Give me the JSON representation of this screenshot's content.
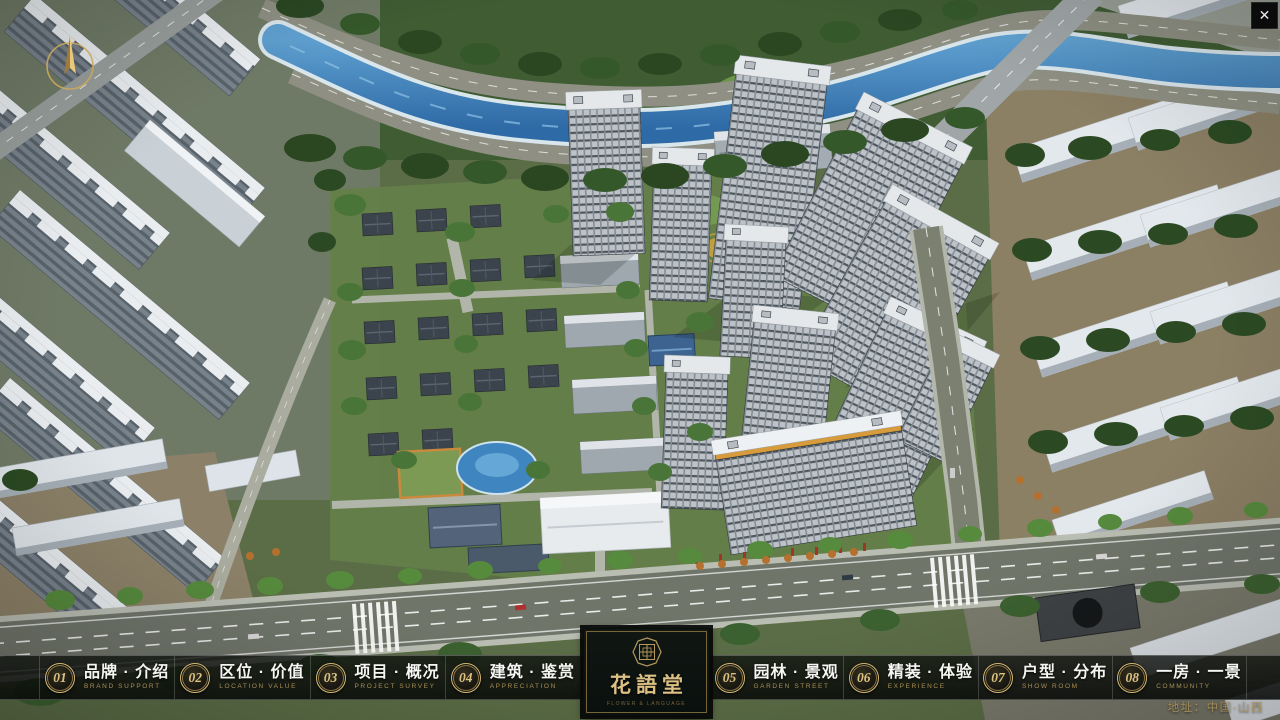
{
  "icons": {
    "close": "✕",
    "compass": "north-arrow",
    "seal": "hua-yu-tang-seal"
  },
  "project": {
    "name": "花語堂",
    "subtitle": "FLOWER & LANGUAGE",
    "address": "地址：中国·山西"
  },
  "menu": {
    "items": [
      {
        "num": "01",
        "label": "品牌 · 介绍",
        "en": "BRAND SUPPORT"
      },
      {
        "num": "02",
        "label": "区位 · 价值",
        "en": "LOCATION VALUE"
      },
      {
        "num": "03",
        "label": "项目 · 概况",
        "en": "PROJECT SURVEY"
      },
      {
        "num": "04",
        "label": "建筑 · 鉴赏",
        "en": "APPRECIATION"
      },
      {
        "num": "05",
        "label": "园林 · 景观",
        "en": "GARDEN STREET"
      },
      {
        "num": "06",
        "label": "精装 · 体验",
        "en": "EXPERIENCE"
      },
      {
        "num": "07",
        "label": "户型 · 分布",
        "en": "SHOW ROOM"
      },
      {
        "num": "08",
        "label": "一房 · 一景",
        "en": "COMMUNITY"
      }
    ]
  },
  "colors": {
    "gold": "#c9a85c",
    "gold_dim": "#a88f55",
    "bar_bg": "rgba(10,13,10,0.82)",
    "panel_bg": "#0d1311",
    "text": "#f5f5f2",
    "river": "#3c7ab4",
    "grass": "#5b6d46"
  }
}
